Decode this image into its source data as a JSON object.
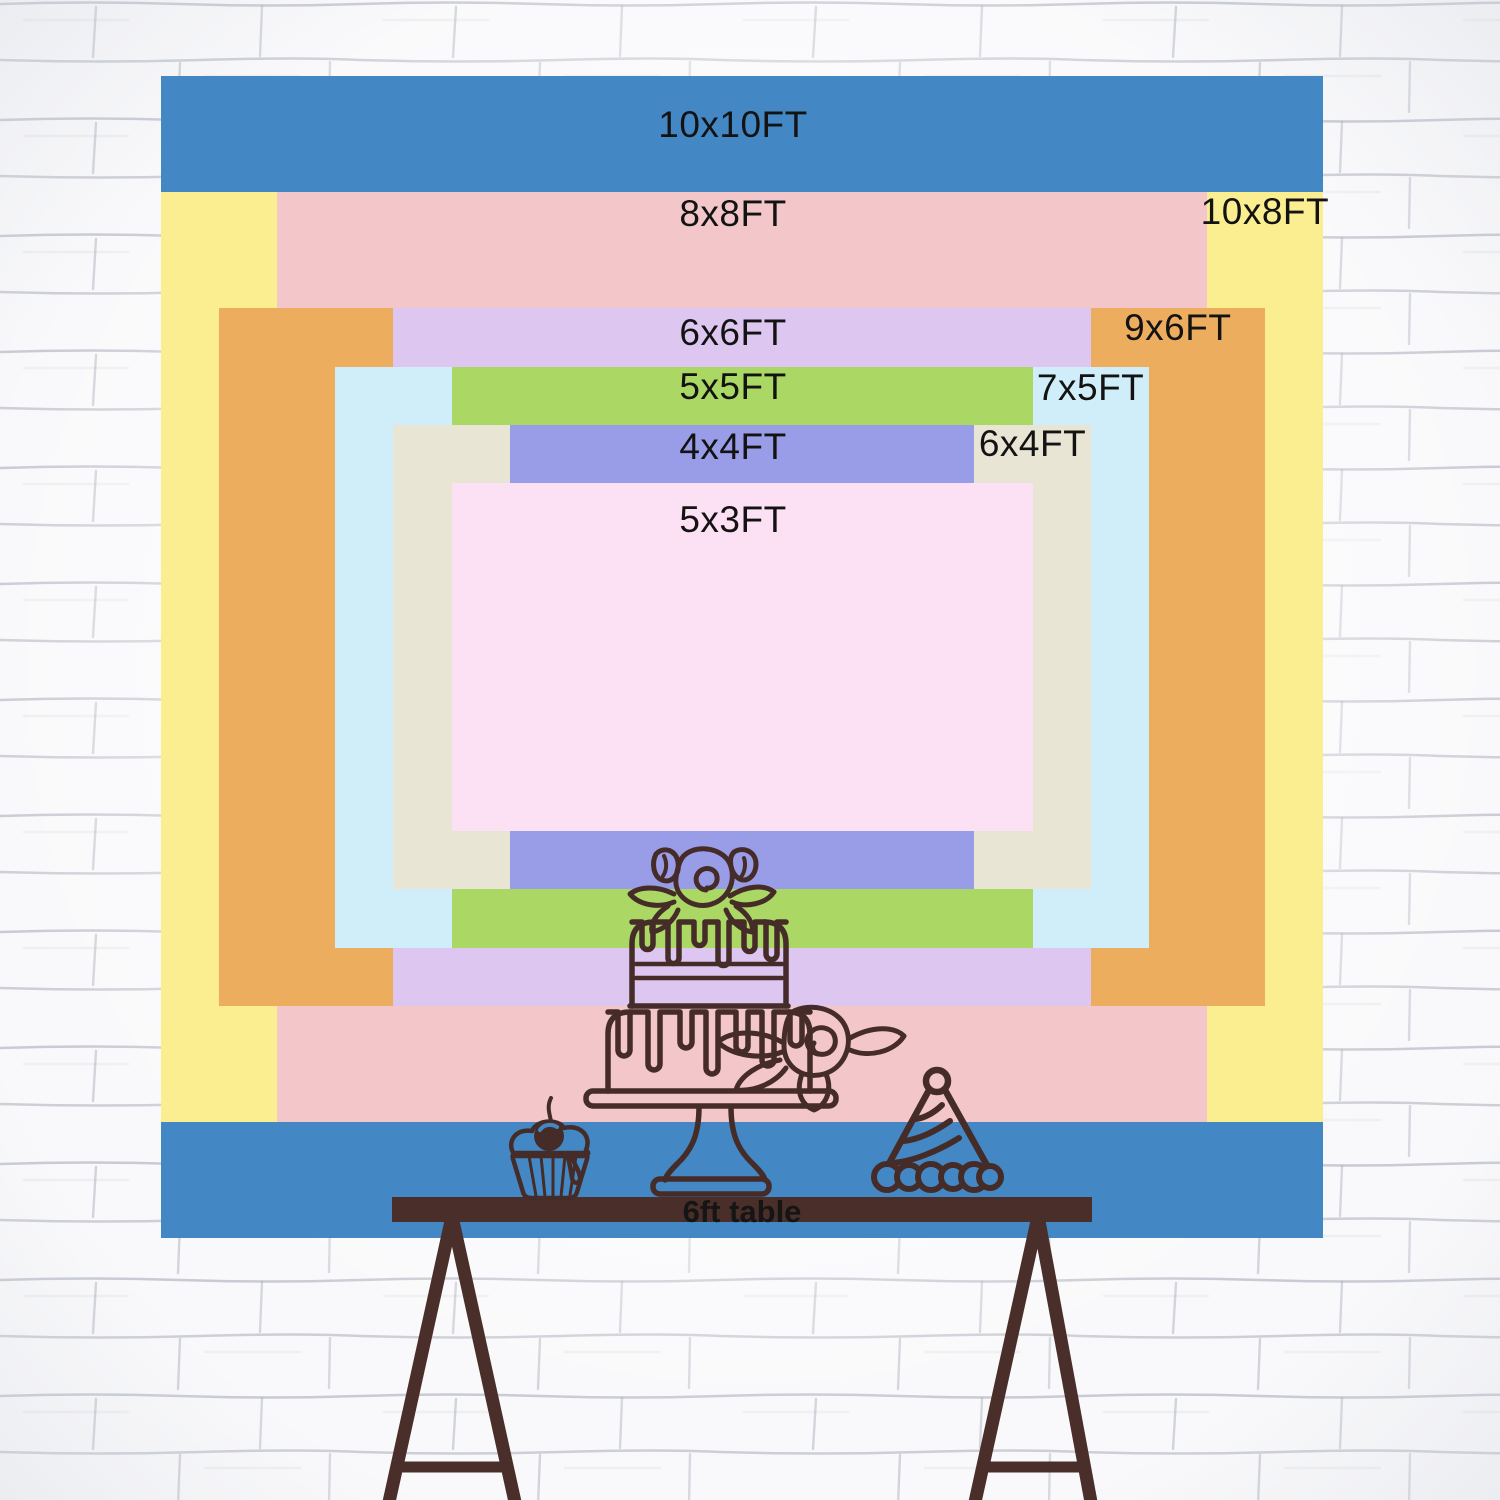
{
  "backdrop": {
    "px_per_ft": 116.2,
    "layers": [
      {
        "name": "10x10ft",
        "label": "10x10FT",
        "color": "#4388C5",
        "ft_w": 10,
        "ft_h": 10,
        "label_pos": "top-center",
        "label_dy": 30
      },
      {
        "name": "10x8ft",
        "label": "10x8FT",
        "color": "#FAEE90",
        "ft_w": 10,
        "ft_h": 8,
        "label_pos": "top-right",
        "label_dy": 1
      },
      {
        "name": "8x8ft",
        "label": "8x8FT",
        "color": "#F3C6C9",
        "ft_w": 8,
        "ft_h": 8,
        "label_pos": "top-center",
        "label_dy": 3
      },
      {
        "name": "9x6ft",
        "label": "9x6FT",
        "color": "#EDAD5E",
        "ft_w": 9,
        "ft_h": 6,
        "label_pos": "top-right",
        "label_dy": 1
      },
      {
        "name": "6x6ft",
        "label": "6x6FT",
        "color": "#DDC6F0",
        "ft_w": 6,
        "ft_h": 6,
        "label_pos": "top-center",
        "label_dy": 6
      },
      {
        "name": "7x5ft",
        "label": "7x5FT",
        "color": "#D0EEFA",
        "ft_w": 7,
        "ft_h": 5,
        "label_pos": "top-right",
        "label_dy": 2
      },
      {
        "name": "5x5ft",
        "label": "5x5FT",
        "color": "#ABD765",
        "ft_w": 5,
        "ft_h": 5,
        "label_pos": "top-center",
        "label_dy": 1
      },
      {
        "name": "6x4ft",
        "label": "6x4FT",
        "color": "#E9E5D5",
        "ft_w": 6,
        "ft_h": 4,
        "label_pos": "top-right",
        "label_dy": 0
      },
      {
        "name": "4x4ft",
        "label": "4x4FT",
        "color": "#999CE7",
        "ft_w": 4,
        "ft_h": 4,
        "label_pos": "top-center",
        "label_dy": 3
      },
      {
        "name": "5x3ft",
        "label": "5x3FT",
        "color": "#FCE0F3",
        "ft_w": 5,
        "ft_h": 3,
        "label_pos": "top-center",
        "label_dy": 18
      }
    ]
  },
  "table": {
    "label": "6ft table",
    "length_ft": 6,
    "color": "#4A2E29",
    "text_color": "#151515"
  },
  "decor": {
    "line_color": "#452C28",
    "items": [
      "two-tier-birthday-cake",
      "cupcake-with-cherry",
      "party-hat"
    ]
  },
  "wall": {
    "style": "white-sketched-brick",
    "line_color": "#A8ADB8"
  }
}
